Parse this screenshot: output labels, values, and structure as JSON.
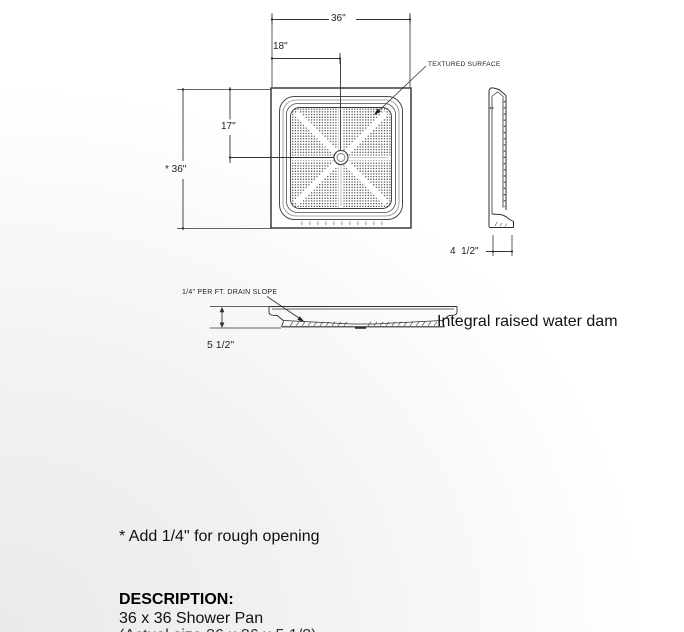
{
  "drawing": {
    "top_view": {
      "dim_overall_width": "36\"",
      "dim_drain_offset_x": "18\"",
      "dim_drain_offset_y": "17\"",
      "dim_overall_height": "* 36\"",
      "textured_surface_label": "TEXTURED SURFACE"
    },
    "side_view": {
      "dim_base_depth": "4  1/2\""
    },
    "section_view": {
      "drain_slope_label": "1/4\" PER FT. DRAIN SLOPE",
      "dim_height": "5 1/2\"",
      "caption": "Integral raised water dam"
    }
  },
  "footnote": "* Add 1/4\" for rough opening",
  "description": {
    "heading": "DESCRIPTION:",
    "product": "36 x 36 Shower Pan",
    "clipped_line": "(Actual size 36 x 36 x 5 1/2)"
  },
  "colors": {
    "line": "#2f2f2f",
    "text": "#1a1a1a",
    "bg_tint": "#e9eaea"
  }
}
